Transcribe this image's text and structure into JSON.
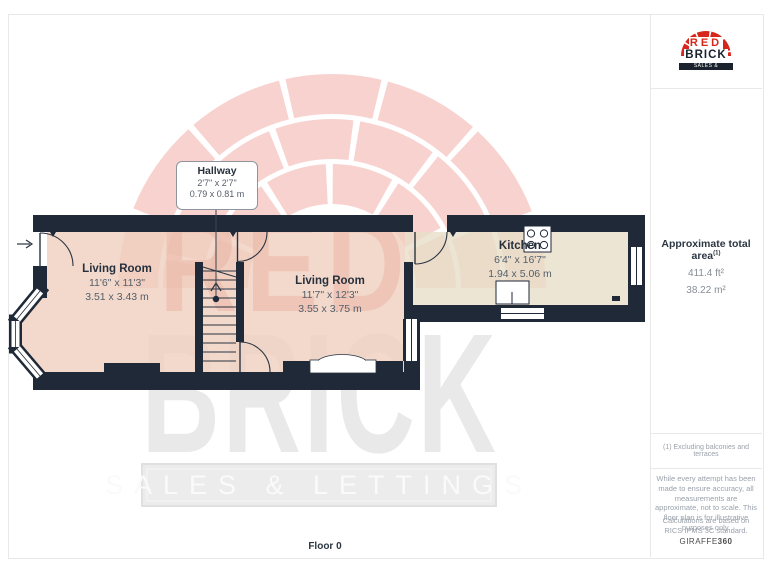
{
  "branding": {
    "line1": "RED",
    "line2": "BRICK",
    "banner": "SALES & LETTINGS",
    "brand_red": "#d7271d",
    "brand_dark": "#1a222e"
  },
  "watermark": {
    "line1": "RED",
    "line2": "BRICK",
    "banner": "SALES & LETTINGS"
  },
  "sidebar": {
    "area": {
      "title": "Approximate total area",
      "sup": "(1)",
      "imperial": "411.4 ft²",
      "metric": "38.22 m²"
    },
    "footnote": "(1) Excluding balconies and terraces",
    "disclaimer1": "While every attempt has been made to ensure accuracy, all measurements are approximate, not to scale. This floor plan is for illustrative purposes only.",
    "disclaimer2": "Calculations are based on RICS IPMS 3C standard.",
    "brand_prefix": "GIRAFFE",
    "brand_suffix": "360"
  },
  "plan": {
    "floor_label": "Floor 0",
    "colors": {
      "wall": "#1f2938",
      "room_fill": "#f2d8ca",
      "kitchen_fill": "#ebe3d0"
    },
    "rooms": {
      "hallway": {
        "name": "Hallway",
        "imperial": "2'7\" x 2'7\"",
        "metric": "0.79 x 0.81 m"
      },
      "living1": {
        "name": "Living Room",
        "imperial": "11'6\" x 11'3\"",
        "metric": "3.51 x 3.43 m"
      },
      "living2": {
        "name": "Living Room",
        "imperial": "11'7\" x 12'3\"",
        "metric": "3.55 x 3.75 m"
      },
      "kitchen": {
        "name": "Kitchen",
        "imperial": "6'4\" x 16'7\"",
        "metric": "1.94 x 5.06 m"
      }
    }
  }
}
